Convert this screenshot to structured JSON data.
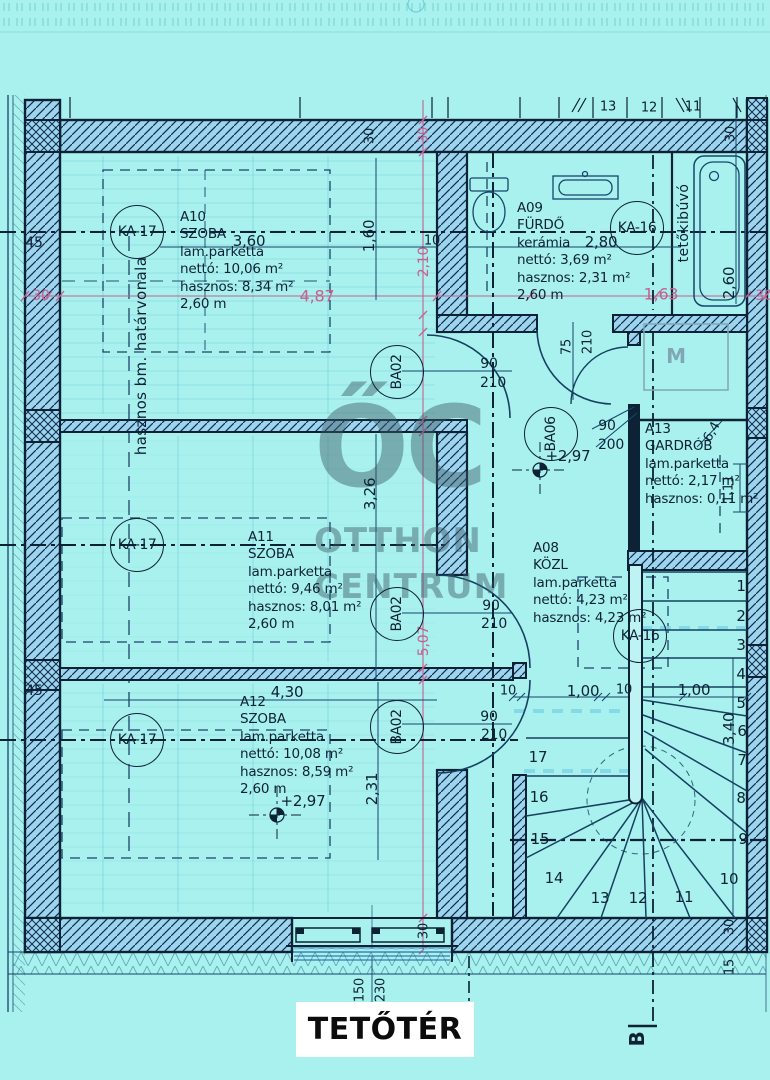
{
  "title": "TETŐTÉR",
  "watermark": {
    "monogram": "ŐC",
    "name_top": "OTTHON",
    "name_bottom": "CENTRUM"
  },
  "colors": {
    "bg": "#a9f1ef",
    "wall": "#9dd4ee",
    "ink": "#0d2235",
    "line": "#17456b",
    "pink": "#c4618e",
    "lightdash": "#7fd7e6",
    "gray": "#7fa7b5",
    "faintgrid": "#35a3b5"
  },
  "rooms": [
    {
      "id": "A10",
      "x": 180,
      "y": 209,
      "lines": [
        "A10",
        "SZOBA",
        "lam.parketta",
        "nettó: 10,06 m²",
        "hasznos: 8,34 m²",
        "2,60 m"
      ]
    },
    {
      "id": "A09",
      "x": 517,
      "y": 200,
      "lines": [
        "A09",
        "FÜRDŐ",
        "kerámia",
        "nettó: 3,69 m²",
        "hasznos: 2,31 m²",
        "2,60 m"
      ]
    },
    {
      "id": "A11",
      "x": 248,
      "y": 529,
      "lines": [
        "A11",
        "SZOBA",
        "lam.parketta",
        "nettó: 9,46 m²",
        "hasznos: 8,01 m²",
        "2,60 m"
      ]
    },
    {
      "id": "A13",
      "x": 645,
      "y": 421,
      "lines": [
        "A13",
        "GARDRÓB",
        "lam.parketta",
        "nettó: 2,17 m²",
        "hasznos: 0,11 m²"
      ]
    },
    {
      "id": "A08",
      "x": 533,
      "y": 540,
      "lines": [
        "A08",
        "KÖZL",
        "lam.parketta",
        "nettó: 4,23 m²",
        "hasznos: 4,23 m²"
      ]
    },
    {
      "id": "A12",
      "x": 240,
      "y": 694,
      "lines": [
        "A12",
        "SZOBA",
        "lam.parketta",
        "nettó: 10,08 m²",
        "hasznos: 8,59 m²",
        "2,60 m"
      ]
    }
  ],
  "markers": [
    {
      "t": "KA-17",
      "x": 137,
      "y": 232,
      "r": 0
    },
    {
      "t": "KA-17",
      "x": 137,
      "y": 545,
      "r": 0
    },
    {
      "t": "KA-17",
      "x": 137,
      "y": 740,
      "r": 0
    },
    {
      "t": "KA-16",
      "x": 637,
      "y": 228,
      "r": 0
    },
    {
      "t": "KA-16",
      "x": 640,
      "y": 636,
      "r": 0
    },
    {
      "t": "BA02",
      "x": 397,
      "y": 372,
      "r": -90
    },
    {
      "t": "BA02",
      "x": 397,
      "y": 614,
      "r": -90
    },
    {
      "t": "BA02",
      "x": 397,
      "y": 727,
      "r": -90
    },
    {
      "t": "BA06",
      "x": 551,
      "y": 434,
      "r": -90
    }
  ],
  "annotations": [
    {
      "t": "3,60",
      "x": 249,
      "y": 241
    },
    {
      "t": "1,60",
      "x": 369,
      "y": 236,
      "r": -90
    },
    {
      "t": "45",
      "x": 34,
      "y": 243,
      "s": 14
    },
    {
      "t": "2,80",
      "x": 601,
      "y": 242
    },
    {
      "t": "2,60",
      "x": 729,
      "y": 283,
      "r": -90
    },
    {
      "t": "30",
      "x": 370,
      "y": 136,
      "r": -90,
      "s": 13
    },
    {
      "t": "13",
      "x": 608,
      "y": 107,
      "s": 13
    },
    {
      "t": "12",
      "x": 649,
      "y": 108,
      "s": 13
    },
    {
      "t": "11",
      "x": 693,
      "y": 107,
      "s": 13
    },
    {
      "t": "30",
      "x": 731,
      "y": 134,
      "r": -90,
      "s": 13
    },
    {
      "t": "10",
      "x": 432,
      "y": 241,
      "s": 13
    },
    {
      "t": "75",
      "x": 567,
      "y": 347,
      "r": -90,
      "s": 13
    },
    {
      "t": "210",
      "x": 588,
      "y": 342,
      "r": -90,
      "s": 13
    },
    {
      "t": "90",
      "x": 489,
      "y": 364,
      "s": 14
    },
    {
      "t": "210",
      "x": 493,
      "y": 383,
      "s": 14
    },
    {
      "t": "90",
      "x": 607,
      "y": 426,
      "s": 14
    },
    {
      "t": "200",
      "x": 611,
      "y": 445,
      "s": 14
    },
    {
      "t": "+2,97",
      "x": 568,
      "y": 456
    },
    {
      "t": "3,26",
      "x": 370,
      "y": 494,
      "r": -90
    },
    {
      "t": "90",
      "x": 491,
      "y": 606,
      "s": 14
    },
    {
      "t": "210",
      "x": 494,
      "y": 624,
      "s": 14
    },
    {
      "t": "90",
      "x": 489,
      "y": 717,
      "s": 14
    },
    {
      "t": "210",
      "x": 494,
      "y": 735,
      "s": 14
    },
    {
      "t": "4,30",
      "x": 287,
      "y": 692
    },
    {
      "t": "2,31",
      "x": 372,
      "y": 789,
      "r": -90
    },
    {
      "t": "+2,97",
      "x": 303,
      "y": 801
    },
    {
      "t": "45",
      "x": 34,
      "y": 691,
      "s": 14
    },
    {
      "t": "10",
      "x": 508,
      "y": 691,
      "s": 13
    },
    {
      "t": "1,00",
      "x": 583,
      "y": 691
    },
    {
      "t": "10",
      "x": 624,
      "y": 690,
      "s": 13
    },
    {
      "t": "1,00",
      "x": 694,
      "y": 690
    },
    {
      "t": "3,40",
      "x": 729,
      "y": 729,
      "r": -90
    },
    {
      "t": "1,11",
      "x": 729,
      "y": 489,
      "r": -90,
      "s": 13
    },
    {
      "t": "6,4",
      "x": 712,
      "y": 432,
      "r": -60,
      "s": 13
    },
    {
      "t": "150",
      "x": 360,
      "y": 990,
      "r": -90,
      "s": 13
    },
    {
      "t": "230",
      "x": 381,
      "y": 990,
      "r": -90,
      "s": 13
    },
    {
      "t": "30",
      "x": 424,
      "y": 931,
      "r": -90,
      "s": 13
    },
    {
      "t": "15",
      "x": 730,
      "y": 967,
      "r": -90,
      "s": 13
    },
    {
      "t": "30",
      "x": 730,
      "y": 927,
      "r": -90,
      "s": 13
    },
    {
      "t": "30",
      "x": 41,
      "y": 296,
      "k": "pink",
      "s": 14
    },
    {
      "t": "4,87",
      "x": 317,
      "y": 296,
      "k": "pink",
      "s": 16
    },
    {
      "t": "1,63",
      "x": 661,
      "y": 294,
      "k": "pink",
      "s": 16
    },
    {
      "t": "30",
      "x": 764,
      "y": 296,
      "k": "pink",
      "s": 14
    },
    {
      "t": "30",
      "x": 424,
      "y": 135,
      "r": -90,
      "k": "pink",
      "s": 13
    },
    {
      "t": "2,10",
      "x": 424,
      "y": 262,
      "r": -90,
      "k": "pink",
      "s": 14
    },
    {
      "t": "5,07",
      "x": 424,
      "y": 641,
      "r": -90,
      "k": "pink",
      "s": 14
    },
    {
      "t": "1",
      "x": 741,
      "y": 586,
      "k": "stair"
    },
    {
      "t": "2",
      "x": 741,
      "y": 616,
      "k": "stair"
    },
    {
      "t": "3",
      "x": 741,
      "y": 645,
      "k": "stair"
    },
    {
      "t": "4",
      "x": 741,
      "y": 674,
      "k": "stair"
    },
    {
      "t": "5",
      "x": 741,
      "y": 703,
      "k": "stair"
    },
    {
      "t": "6",
      "x": 742,
      "y": 731,
      "k": "stair"
    },
    {
      "t": "7",
      "x": 742,
      "y": 760,
      "k": "stair"
    },
    {
      "t": "8",
      "x": 741,
      "y": 798,
      "k": "stair"
    },
    {
      "t": "9",
      "x": 743,
      "y": 839,
      "k": "stair"
    },
    {
      "t": "10",
      "x": 729,
      "y": 879,
      "k": "stair"
    },
    {
      "t": "11",
      "x": 684,
      "y": 897,
      "k": "stair"
    },
    {
      "t": "12",
      "x": 638,
      "y": 898,
      "k": "stair"
    },
    {
      "t": "13",
      "x": 600,
      "y": 898,
      "k": "stair"
    },
    {
      "t": "14",
      "x": 554,
      "y": 878,
      "k": "stair"
    },
    {
      "t": "15",
      "x": 540,
      "y": 839,
      "k": "stair"
    },
    {
      "t": "16",
      "x": 539,
      "y": 797,
      "k": "stair"
    },
    {
      "t": "17",
      "x": 538,
      "y": 757,
      "k": "stair"
    },
    {
      "t": "M",
      "x": 676,
      "y": 356,
      "k": "faint",
      "s": 20,
      "n": "washing-machine-label"
    },
    {
      "t": "B",
      "x": 637,
      "y": 1039,
      "r": -90,
      "k": "sec",
      "s": 20,
      "n": "section-marker-label"
    },
    {
      "t": "hasznos bm. határvonala",
      "x": 141,
      "y": 356,
      "r": -90,
      "k": "note",
      "s": 15,
      "n": "boundary-line-note"
    },
    {
      "t": "tetőkibúvó",
      "x": 684,
      "y": 223,
      "r": -90,
      "k": "note",
      "s": 14,
      "n": "roof-hatch-label"
    }
  ]
}
